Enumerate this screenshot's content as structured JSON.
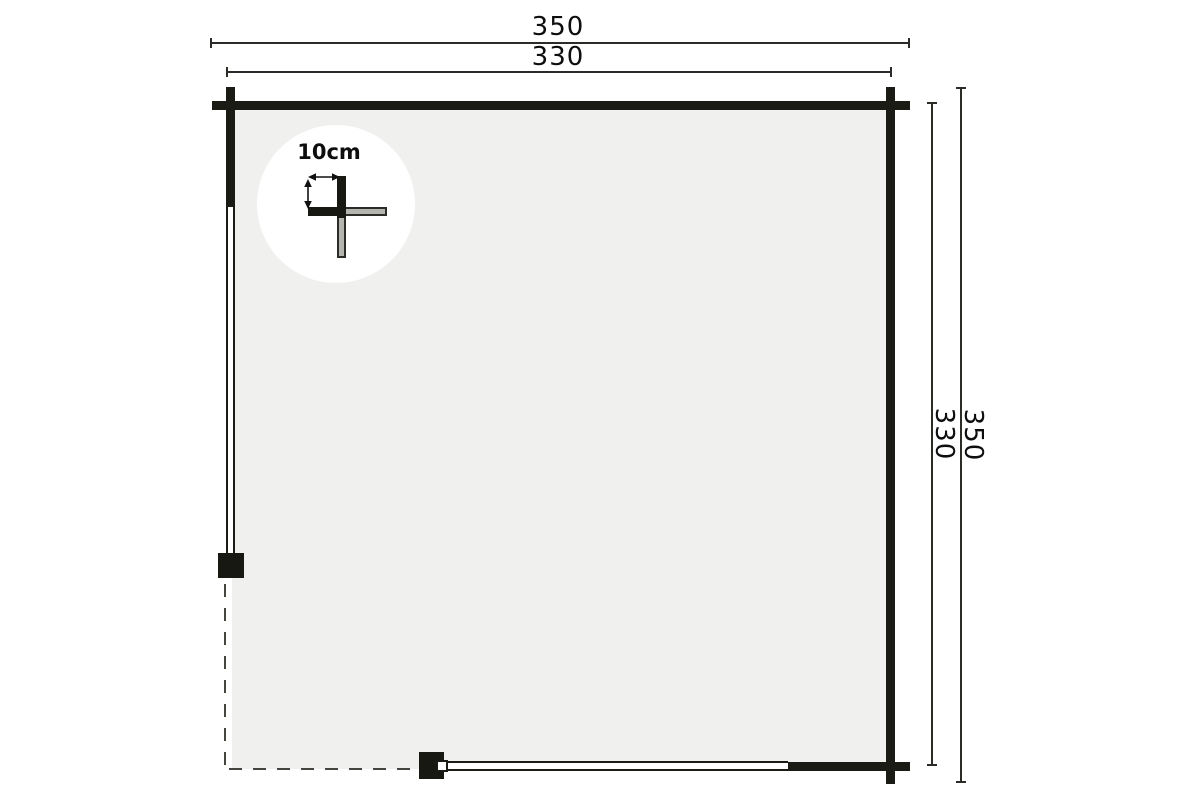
{
  "plan": {
    "dimensions": {
      "top_outer": "350",
      "top_inner": "330",
      "right_inner": "330",
      "right_outer": "350"
    },
    "detail": {
      "label": "10cm"
    },
    "colors": {
      "wall": "#1b1b16",
      "floor": "#f0f0ef",
      "log_gray": "#b5b5b0",
      "dimension_line": "#2b2b28",
      "background": "#ffffff"
    }
  }
}
